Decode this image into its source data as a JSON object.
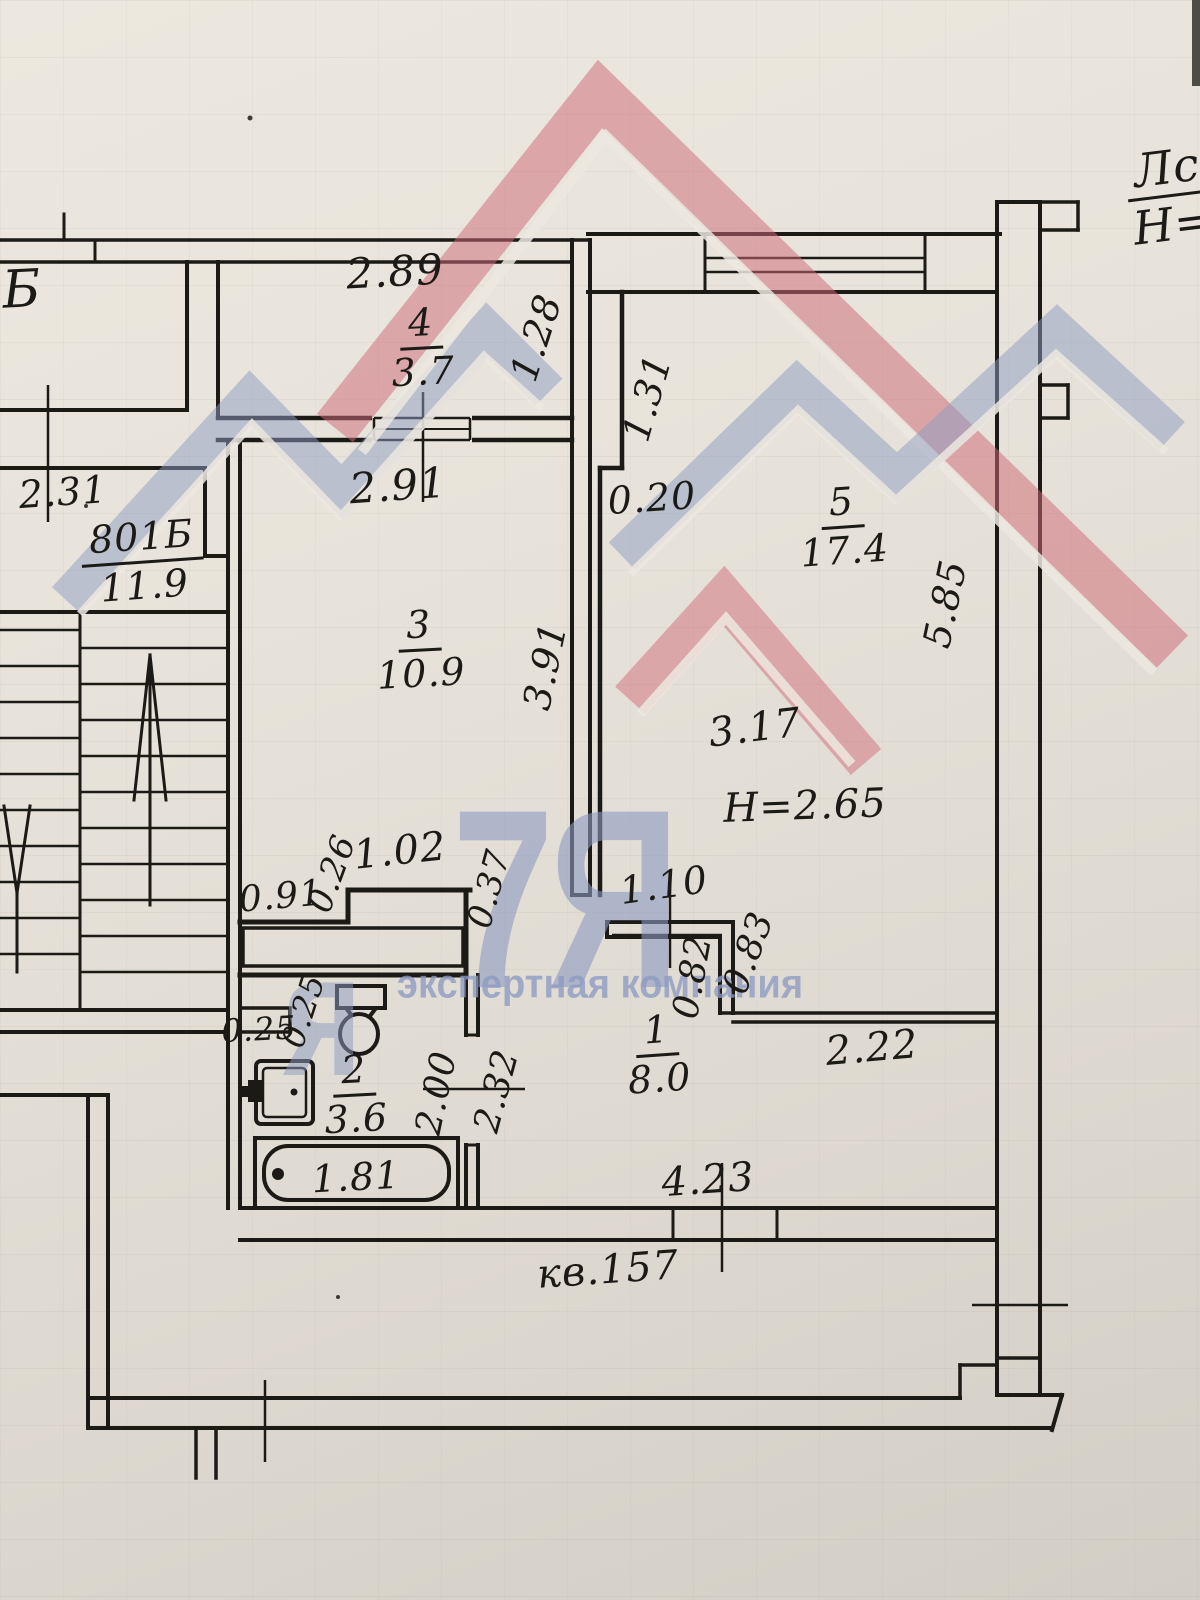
{
  "watermark": {
    "big": "7Я",
    "partial": "я",
    "caption": "экспертная компания",
    "red": "#cf6b77",
    "blue": "#8d9bc2"
  },
  "corner": {
    "top": "Лс",
    "bottom": "Н="
  },
  "stairwell": {
    "neighbor_label": "Б",
    "dim": "2.31",
    "unit_number": "801Б",
    "unit_area": "11.9"
  },
  "balcony": {
    "width": "2.89",
    "num": "4",
    "area": "3.7",
    "side": "1.28"
  },
  "room3": {
    "width": "2.91",
    "num": "3",
    "area": "10.9",
    "side": "3.91"
  },
  "room5": {
    "jog_v": "1.31",
    "jog_h": "0.20",
    "num": "5",
    "area": "17.4",
    "side": "5.85",
    "width": "3.17",
    "height_note": "Н=2.65"
  },
  "closet": {
    "left": "0.91",
    "depth": "0.26",
    "width": "1.02",
    "wall": "0.37"
  },
  "hall": {
    "door": "1.10",
    "niche_a": "0.82",
    "niche_b": "0.83",
    "num": "1",
    "area": "8.0",
    "niche_w": "2.22",
    "pass": "2.32",
    "entry": "4.23",
    "apt": "кв.157"
  },
  "bath": {
    "vent_a": "0.25",
    "vent_b": "0.25",
    "num": "2",
    "area": "3.6",
    "side": "2.00",
    "tub": "1.81"
  }
}
